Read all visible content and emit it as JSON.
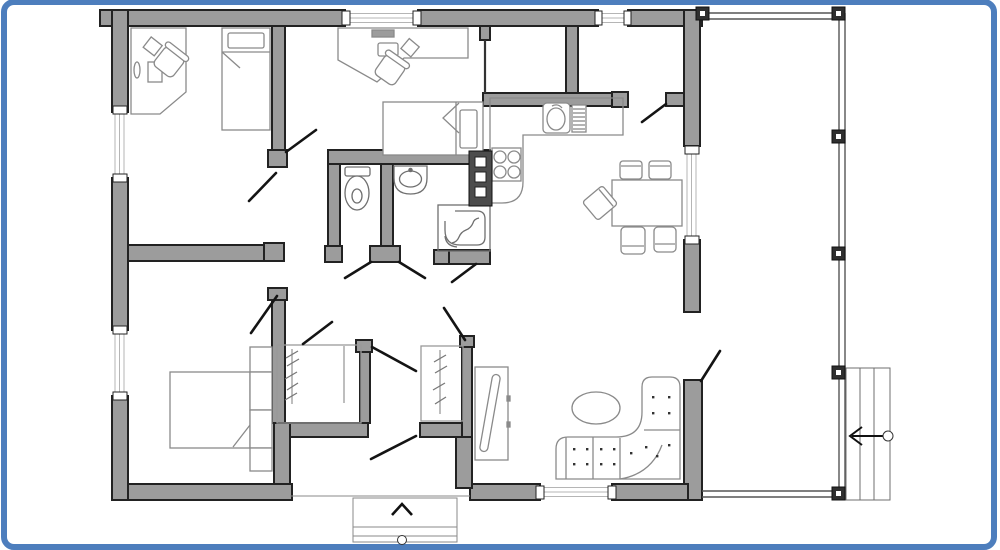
{
  "meta": {
    "description": "Top-down 2D architectural floor plan of a single-storey house with a side deck, side steps and a front entry stoop, framed by a blue rounded border",
    "style": "monochrome line drawing, gray filled walls"
  },
  "colors": {
    "frame": "#4d7ebd",
    "background": "#ffffff",
    "wall_fill": "#9c9c9c",
    "wall_stroke": "#222222",
    "door": "#141414",
    "furniture": "#8a8a8a",
    "fixture": "#6f6f6f",
    "glazing": "#b5b5b5",
    "railing": "#555555",
    "post_fill": "#2f2f2f",
    "boiler_fill": "#4c4c4c"
  },
  "rooms": [
    {
      "id": "bedroom-office-nw",
      "name": "Bedroom / office (top left)",
      "furniture": [
        "corner desk with computer and mouse",
        "swivel chair",
        "single bed with pillow and folded blanket"
      ]
    },
    {
      "id": "bedroom-n",
      "name": "Bedroom / study (top middle)",
      "furniture": [
        "wall desk with monitor",
        "swivel chair",
        "single bed with pillow and folded blanket"
      ]
    },
    {
      "id": "storage-ne-1",
      "name": "Small storage room (top centre-right)",
      "furniture": []
    },
    {
      "id": "storage-ne-2",
      "name": "Small room (top right, door to dining)",
      "furniture": []
    },
    {
      "id": "wc",
      "name": "WC",
      "furniture": [
        "toilet with cistern"
      ]
    },
    {
      "id": "bathroom",
      "name": "Bathroom",
      "furniture": [
        "washbasin",
        "corner shower cabin with curved door",
        "water-heater column with three panels"
      ]
    },
    {
      "id": "kitchen",
      "name": "Kitchen (open)",
      "furniture": [
        "L-shaped counter with rounded end",
        "sink with draining board",
        "4-burner stove"
      ]
    },
    {
      "id": "dining-area",
      "name": "Dining area",
      "furniture": [
        "rectangular dining table",
        "five chairs (two top, two bottom, one angled left)"
      ]
    },
    {
      "id": "living-room",
      "name": "Living room",
      "furniture": [
        "L-shaped tufted corner sofa",
        "oval coffee table",
        "TV sideboard with angled screen"
      ]
    },
    {
      "id": "bedroom-sw",
      "name": "Bedroom (bottom left)",
      "furniture": [
        "double bed with folded corner",
        "column of nightstand shelves"
      ]
    },
    {
      "id": "hallway",
      "name": "Central hallway",
      "furniture": [
        "built-in wardrobe with hanging rail (left)",
        "built-in wardrobe with hanging rail (right)"
      ]
    },
    {
      "id": "entry",
      "name": "Front entry stoop",
      "furniture": [
        "entry steps with up arrow and start circle"
      ]
    },
    {
      "id": "deck",
      "name": "Side deck / terrace (right)",
      "furniture": [
        "perimeter railing with six posts",
        "three side steps with left-pointing arrow and start circle"
      ]
    }
  ],
  "openings": {
    "window_count": 6,
    "windows": [
      "top wall left",
      "top wall small right",
      "right wall upper",
      "bottom wall living room",
      "left wall upper",
      "left wall lower"
    ],
    "door_count": 12,
    "doors": [
      "bedroom-n door",
      "bedroom-office door",
      "bedroom-sw door",
      "wc door",
      "bathroom door",
      "left wardrobe door",
      "hall-to-entry door",
      "hall double door leaf A",
      "hall double door leaf B",
      "front entrance door",
      "storage-to-dining door",
      "living-to-deck door"
    ]
  },
  "annotations": {
    "entry_steps_arrow": "^",
    "deck_steps_arrow": "<"
  }
}
